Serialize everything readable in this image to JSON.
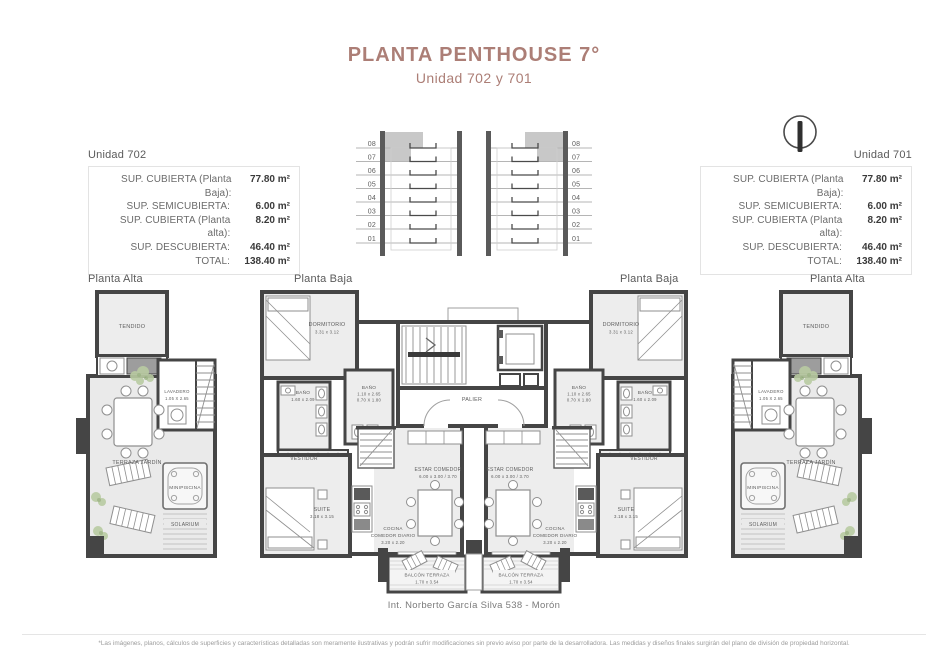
{
  "header": {
    "title": "PLANTA PENTHOUSE 7°",
    "subtitle": "Unidad 702 y 701"
  },
  "colors": {
    "accent": "#ac7e76",
    "wall": "#454545",
    "floor_fill": "#ededed",
    "elevation_highlight": "#c8c8c8"
  },
  "elevation": {
    "floors": [
      "08",
      "07",
      "06",
      "05",
      "04",
      "03",
      "02",
      "01"
    ]
  },
  "compass": {
    "icon": "north-indicator"
  },
  "units": {
    "unit702": {
      "name": "Unidad 702",
      "rows": [
        {
          "label": "SUP. CUBIERTA (Planta Baja):",
          "value": "77.80 m²"
        },
        {
          "label": "SUP. SEMICUBIERTA:",
          "value": "6.00 m²"
        },
        {
          "label": "SUP. CUBIERTA (Planta alta):",
          "value": "8.20 m²"
        },
        {
          "label": "SUP. DESCUBIERTA:",
          "value": "46.40 m²"
        },
        {
          "label": "TOTAL:",
          "value": "138.40 m²"
        }
      ]
    },
    "unit701": {
      "name": "Unidad 701",
      "rows": [
        {
          "label": "SUP. CUBIERTA (Planta Baja):",
          "value": "77.80 m²"
        },
        {
          "label": "SUP. SEMICUBIERTA:",
          "value": "6.00 m²"
        },
        {
          "label": "SUP. CUBIERTA (Planta alta):",
          "value": "8.20 m²"
        },
        {
          "label": "SUP. DESCUBIERTA:",
          "value": "46.40 m²"
        },
        {
          "label": "TOTAL:",
          "value": "138.40 m²"
        }
      ]
    }
  },
  "plans": {
    "alta_left": {
      "title": "Planta Alta",
      "tendido": "TENDIDO",
      "lavadero": "LAVADERO",
      "lavadero_dim": "1.05 X 2.65",
      "terraza": "TERRAZA JARDÍN",
      "minipiscina": "MINIPISCINA",
      "solarium": "SOLARIUM"
    },
    "baja_left": {
      "title": "Planta Baja",
      "dormitorio": "DORMITORIO",
      "dormitorio_dim": "3.31 x 3.12",
      "bano_a": "BAÑO",
      "bano_a_dim": "1.60 x 2.09",
      "bano_b": "BAÑO",
      "bano_b_dim1": "1.10 x 2.65",
      "bano_b_dim2": "0.70 X 1.80",
      "vestidor": "VESTIDOR",
      "suite": "SUITE",
      "suite_dim": "3.18 x 3.15",
      "cocina_1": "COCINA",
      "cocina_2": "COMEDOR DIARIO",
      "cocina_dim": "3.20 x 2.20",
      "estar": "ESTAR COMEDOR",
      "estar_dim": "6.00 x 3.00 / 3.70",
      "balcon": "BALCÓN TERRAZA",
      "balcon_dim": "1.70 x 3.54"
    },
    "baja_right": {
      "title": "Planta Baja",
      "dormitorio": "DORMITORIO",
      "dormitorio_dim": "3.31 x 3.12",
      "bano_a": "BAÑO",
      "bano_a_dim": "1.60 x 2.09",
      "bano_b": "BAÑO",
      "bano_b_dim1": "1.10 x 2.65",
      "bano_b_dim2": "0.70 X 1.80",
      "vestidor": "VESTIDOR",
      "suite": "SUITE",
      "suite_dim": "3.18 x 3.15",
      "cocina_1": "COCINA",
      "cocina_2": "COMEDOR DIARIO",
      "cocina_dim": "3.20 x 2.20",
      "estar": "ESTAR COMEDOR",
      "estar_dim": "6.00 x 3.00 / 3.70",
      "balcon": "BALCÓN TERRAZA",
      "balcon_dim": "1.70 x 3.54"
    },
    "alta_right": {
      "title": "Planta Alta",
      "tendido": "TENDIDO",
      "lavadero": "LAVADERO",
      "lavadero_dim": "1.05 X 2.65",
      "terraza": "TERRAZA JARDÍN",
      "minipiscina": "MINIPISCINA",
      "solarium": "SOLARIUM"
    },
    "core": {
      "palier": "PALIER"
    }
  },
  "footer": {
    "address": "Int. Norberto García Silva 538 - Morón",
    "disclaimer": "*Las imágenes, planos, cálculos de superficies y características detalladas son meramente ilustrativas y podrán sufrir modificaciones sin previo aviso por parte de la desarrolladora. Las medidas y diseños finales surgirán del plano de división de propiedad horizontal."
  }
}
